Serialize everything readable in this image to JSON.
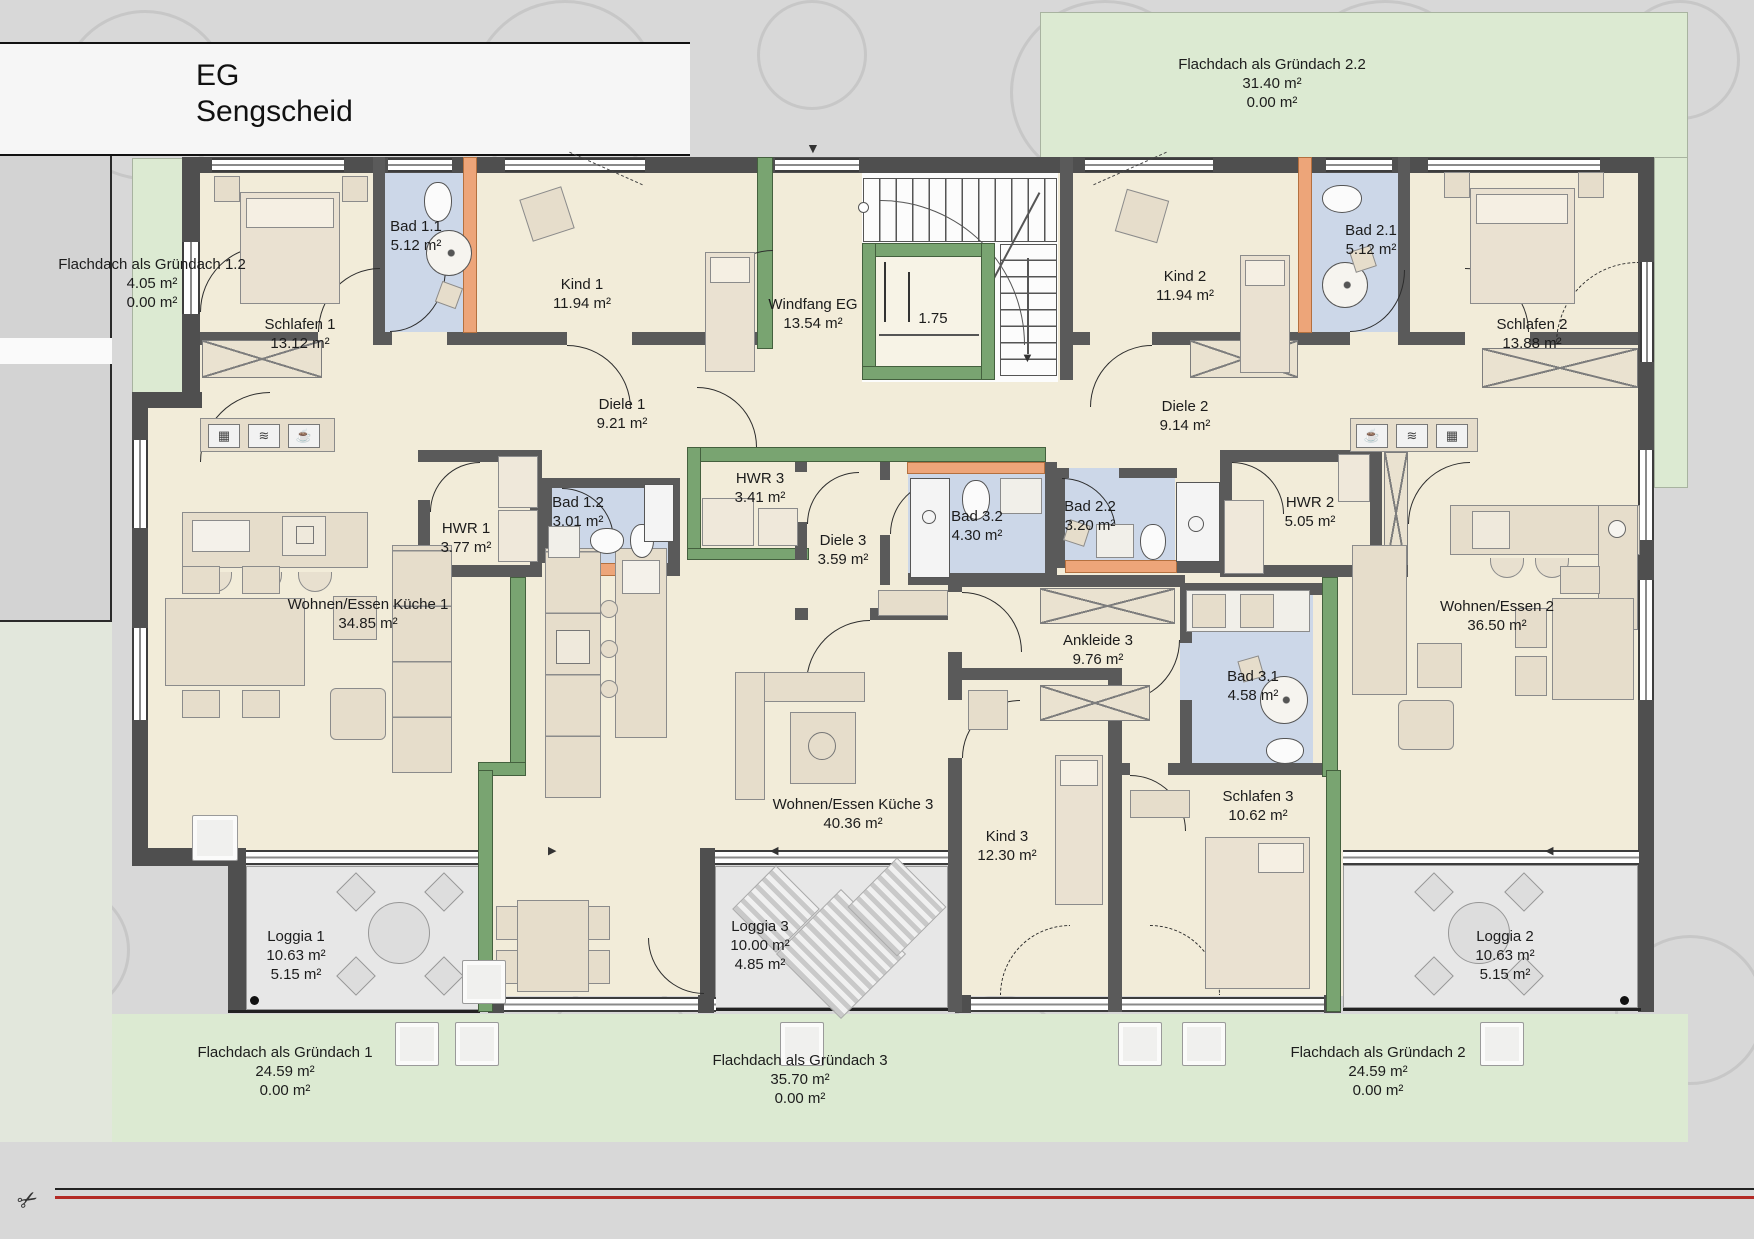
{
  "title": {
    "floor": "EG",
    "project": "Sengscheid"
  },
  "stair": {
    "dim": "1.75"
  },
  "glyphs": {
    "cup": "☕",
    "waves": "≋",
    "grid": "▦",
    "arrow_down": "▼",
    "arrow_left": "◀",
    "arrow_right": "▶"
  },
  "colors": {
    "wall_green": "#79a471",
    "wall_orange": "#eda579",
    "bath_blue": "#ccd7e8",
    "roof_green": "#dcead2",
    "room_cream": "#f2ecd9"
  },
  "rooms": {
    "schlafen1": {
      "name": "Schlafen 1",
      "area": "13.12 m²"
    },
    "bad11": {
      "name": "Bad 1.1",
      "area": "5.12 m²"
    },
    "kind1": {
      "name": "Kind 1",
      "area": "11.94 m²"
    },
    "windfang": {
      "name": "Windfang EG",
      "area": "13.54 m²"
    },
    "kind2": {
      "name": "Kind 2",
      "area": "11.94 m²"
    },
    "bad21": {
      "name": "Bad 2.1",
      "area": "5.12 m²"
    },
    "schlafen2": {
      "name": "Schlafen 2",
      "area": "13.88 m²"
    },
    "diele1": {
      "name": "Diele 1",
      "area": "9.21 m²"
    },
    "diele2": {
      "name": "Diele 2",
      "area": "9.14 m²"
    },
    "hwr1": {
      "name": "HWR 1",
      "area": "3.77 m²"
    },
    "bad12": {
      "name": "Bad 1.2",
      "area": "3.01 m²"
    },
    "hwr3": {
      "name": "HWR 3",
      "area": "3.41 m²"
    },
    "diele3": {
      "name": "Diele 3",
      "area": "3.59 m²"
    },
    "bad32": {
      "name": "Bad 3.2",
      "area": "4.30 m²"
    },
    "bad22": {
      "name": "Bad 2.2",
      "area": "3.20 m²"
    },
    "hwr2": {
      "name": "HWR 2",
      "area": "5.05 m²"
    },
    "wohnen1": {
      "name": "Wohnen/Essen Küche 1",
      "area": "34.85 m²"
    },
    "wohnen2": {
      "name": "Wohnen/Essen 2",
      "area": "36.50 m²"
    },
    "wohnen3": {
      "name": "Wohnen/Essen Küche 3",
      "area": "40.36 m²"
    },
    "ankleide3": {
      "name": "Ankleide 3",
      "area": "9.76 m²"
    },
    "bad31": {
      "name": "Bad 3.1",
      "area": "4.58 m²"
    },
    "kind3": {
      "name": "Kind 3",
      "area": "12.30 m²"
    },
    "schlafen3": {
      "name": "Schlafen 3",
      "area": "10.62 m²"
    },
    "loggia1": {
      "name": "Loggia 1",
      "area1": "10.63 m²",
      "area2": "5.15 m²"
    },
    "loggia2": {
      "name": "Loggia 2",
      "area1": "10.63 m²",
      "area2": "5.15 m²"
    },
    "loggia3": {
      "name": "Loggia 3",
      "area1": "10.00 m²",
      "area2": "4.85 m²"
    },
    "gruendach1": {
      "name": "Flachdach als Gründach 1",
      "area1": "24.59 m²",
      "area2": "0.00 m²"
    },
    "gruendach2": {
      "name": "Flachdach als Gründach 2",
      "area1": "24.59 m²",
      "area2": "0.00 m²"
    },
    "gruendach3": {
      "name": "Flachdach als Gründach 3",
      "area1": "35.70 m²",
      "area2": "0.00 m²"
    },
    "gruendach12": {
      "name": "Flachdach als Gründach 1.2",
      "area1": "4.05 m²",
      "area2": "0.00 m²"
    },
    "gruendach22": {
      "name": "Flachdach als Gründach 2.2",
      "area1": "31.40 m²",
      "area2": "0.00 m²"
    }
  }
}
